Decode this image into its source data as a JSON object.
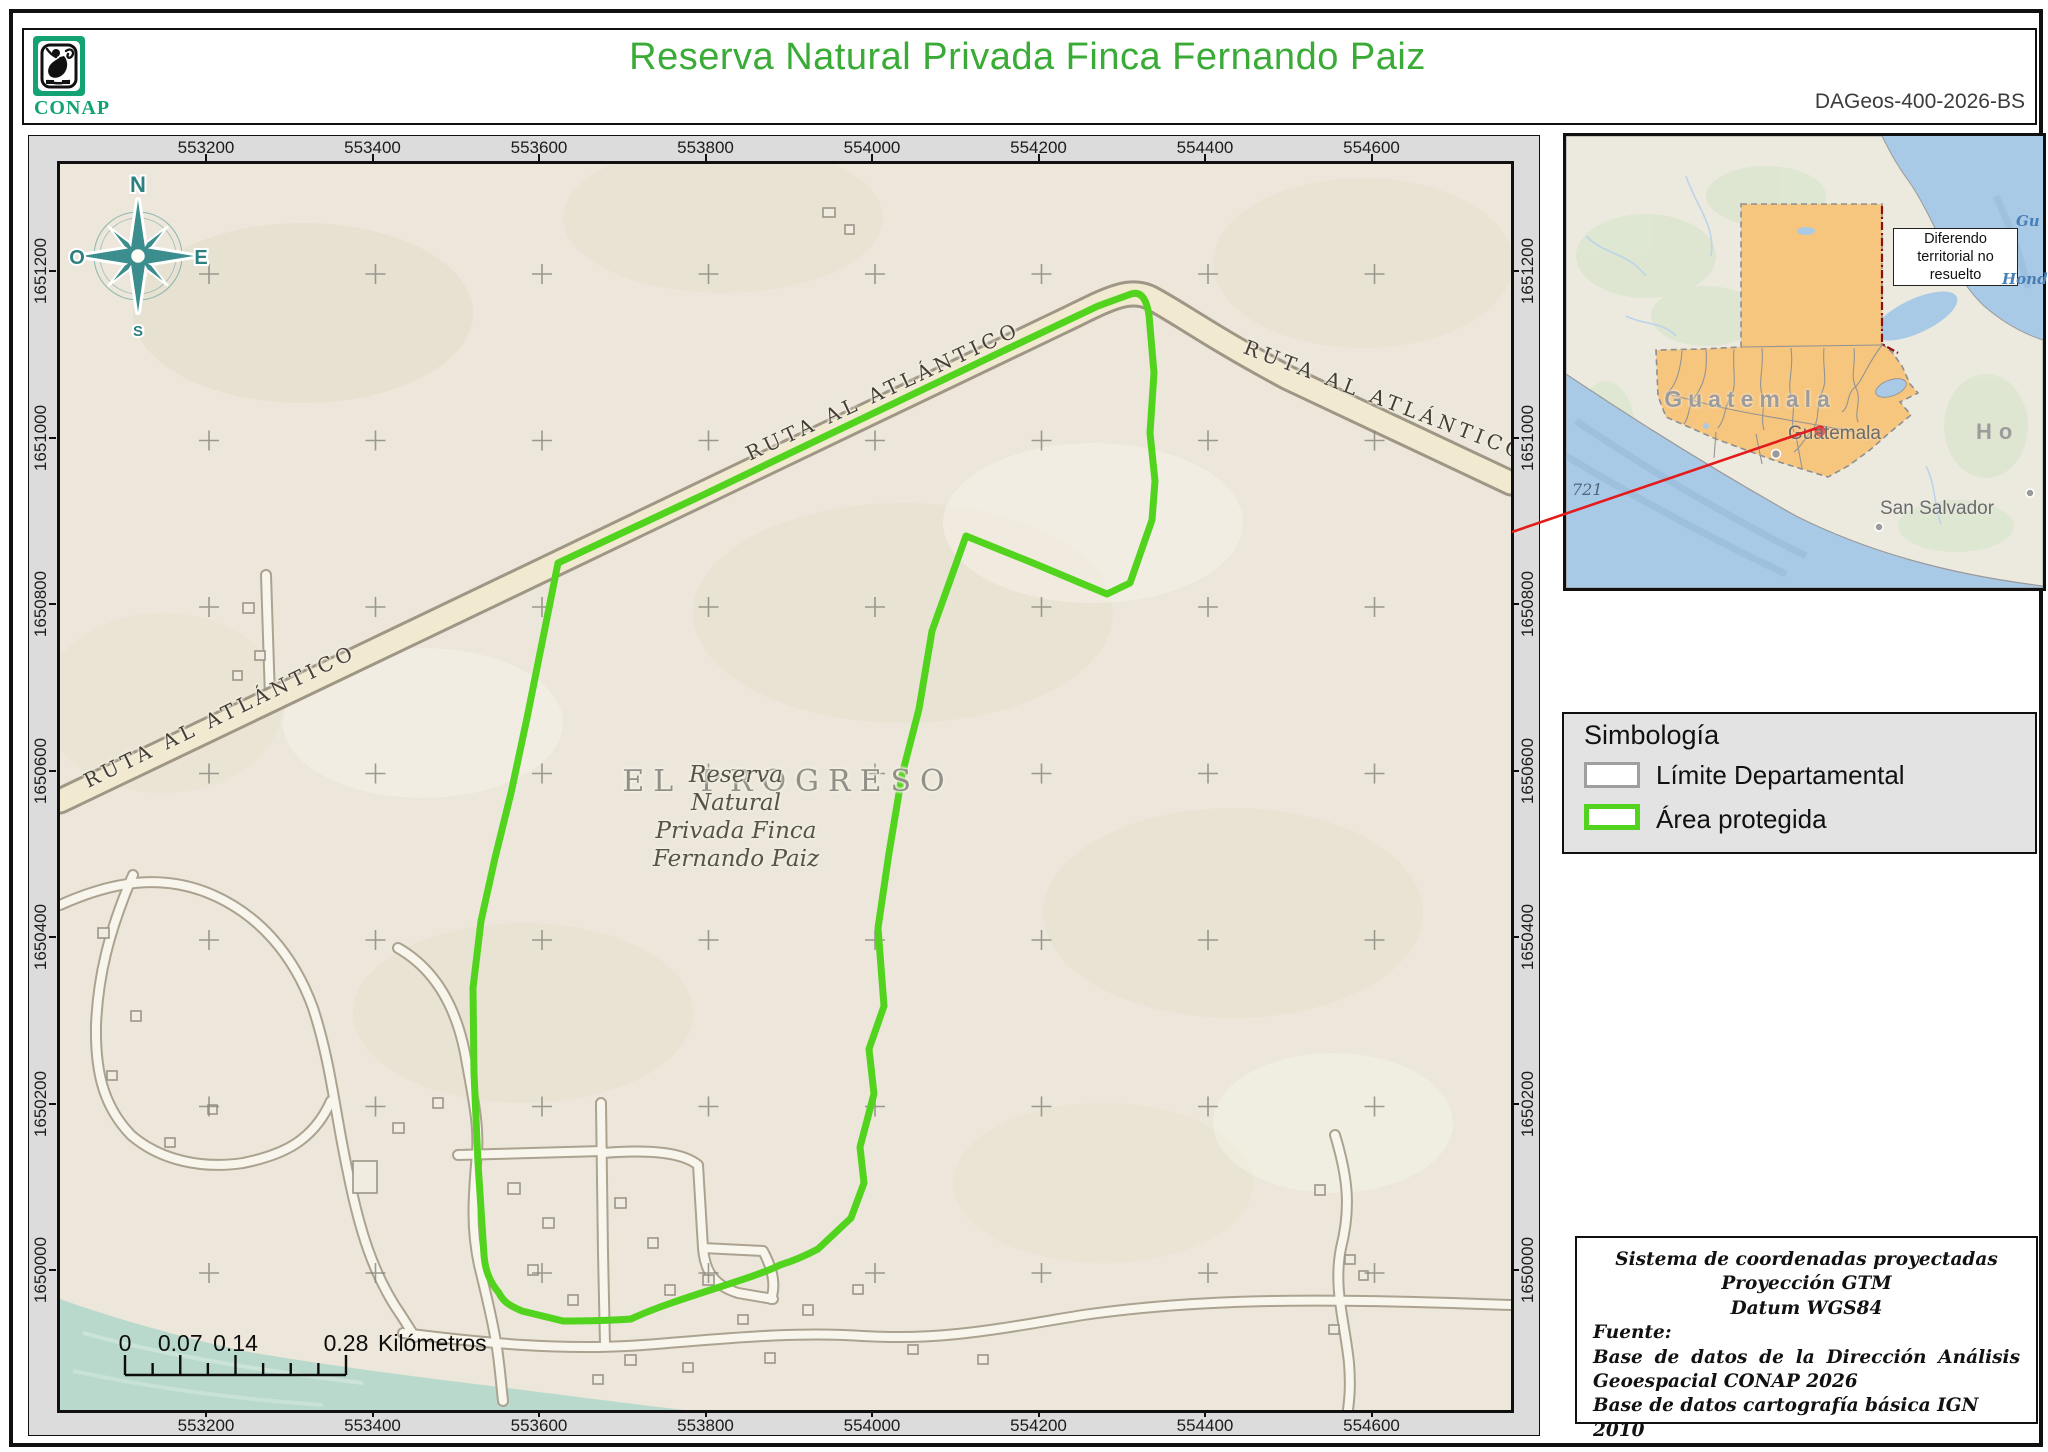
{
  "header": {
    "logo_text": "CONAP",
    "title": "Reserva Natural Privada Finca Fernando Paiz",
    "sheet_code": "DAGeos-400-2026-BS"
  },
  "map": {
    "eastings": [
      "553200",
      "553400",
      "553600",
      "553800",
      "554000",
      "554200",
      "554400",
      "554600"
    ],
    "northings": [
      "1651200",
      "1651000",
      "1650800",
      "1650600",
      "1650400",
      "1650200",
      "1650000"
    ],
    "compass": {
      "n": "N",
      "e": "E",
      "s": "S",
      "w": "O"
    },
    "labels": {
      "municipality": "EL PROGRESO",
      "reserve_name": "Reserva\nNatural\nPrivada Finca\nFernando Paiz",
      "highway": "RUTA AL ATLÁNTICO"
    },
    "scalebar": {
      "ticks": [
        "0",
        "0.07",
        "0.14",
        "0.28"
      ],
      "unit": "Kilómetros"
    }
  },
  "inset": {
    "note": "Diferendo territorial no resuelto",
    "country_label": "Guatemala",
    "city_label": "Guatemala",
    "san_salvador_label": "San Salvador",
    "honduras_label": "Ho",
    "depth_label": "721",
    "ocean_label_1": "Gu",
    "ocean_label_2": "Hond"
  },
  "legend": {
    "title": "Simbología",
    "items": [
      {
        "label": "Límite Departamental",
        "swatch_color": "#9f9f9f"
      },
      {
        "label": "Área protegida",
        "swatch_color": "#52d41e"
      }
    ]
  },
  "credits": {
    "line1": "Sistema de coordenadas proyectadas",
    "line2": "Proyección GTM",
    "line3": "Datum WGS84",
    "fuente": "Fuente:",
    "source1": "Base de datos de la Dirección Análisis Geoespacial CONAP 2026",
    "source2": "Base de datos cartografía básica IGN 2010"
  },
  "colors": {
    "title_green": "#3aab36",
    "conap_green": "#12a273",
    "protected_area_green": "#52d41e",
    "limite_gray": "#9f9f9f",
    "locator_red": "#e31b1b",
    "dispute_red": "#8b1010",
    "guatemala_orange": "#f6c57e",
    "water_teal": "#b9d9cc",
    "inset_ocean_blue": "#a9cae6",
    "paper": "#ece7da"
  }
}
